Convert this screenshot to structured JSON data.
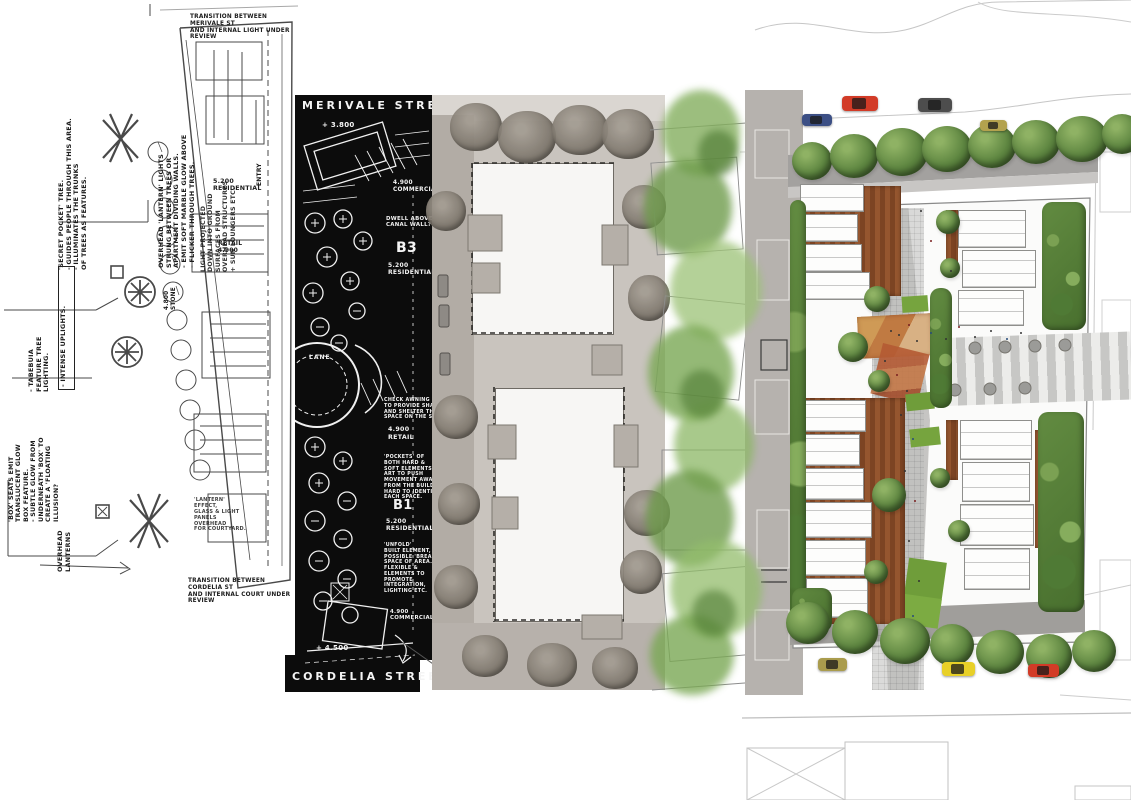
{
  "title": "Masterplan design process — sketch to render, Merivale to Cordelia Street",
  "colors": {
    "black_panel": "#0c0c0c",
    "collage_grey": "#c9c4be",
    "render_tree_green": "#5d8540",
    "rust_brown": "#8a4e2a",
    "plaza_orange": "#bf7a42",
    "car_red": "#d23b27",
    "car_dark_grey": "#4d4d4d",
    "car_yellow": "#e8d028",
    "car_tan": "#b3a24e",
    "car_blue": "#3c4f85"
  },
  "sketch": {
    "top_note": "TRANSITION BETWEEN MERIVALE ST\nAND INTERNAL LIGHT UNDER REVIEW",
    "bottom_note": "TRANSITION BETWEEN CORDELIA ST\nAND INTERNAL COURT UNDER\nREVIEW",
    "lantern_lights": "OVERHEAD 'LANTERN' LIGHTS\nSTRUNG BETWEEN TREES OR\nAPARTMENT DIVIDING WALLS.\n- EMIT SOFT MARBLE GLOW ABOVE\n- FLICKER THROUGH TREES.",
    "secret_pocket": "'SECRET POCKET' TREE.\n- GUIDES PEOPLE THROUGH THIS AREA.\n- ILLUMINATES THE TRUNKS\n  OF TREES AS FEATURES.",
    "tabebuia": "- TABEBUIA\n  FEATURE TREE\n  LIGHTING.",
    "intense_uplights": "- INTENSE UPLIGHTS.",
    "box_seats": "'BOX' SEATS EMIT\nTRANSLUCENT GLOW\nBOX FEATURE.\n- SUBTLE GLOW FROM\n  UNDERNEATH 'BOX' TO\n  CREATE A 'FLOATING\n  ILLUSION?",
    "overhead_lanterns": "OVERHEAD\nLANTERNS",
    "light_projected": "LIGHT PROJECTED\nDOWN INTO GROUND\nSURFACES FROM\nOVERHEAD STRUCTURES\n+ SUN LOUNGERS ETC.",
    "stone": "4.800\nSTONE",
    "entry": "ENTRY",
    "residential": "5.200\nRESIDENTIAL",
    "retail": "RETAIL\n4.900",
    "lantern_effect": "'LANTERN' EFFECT,\nGLASS & LIGHT\nPANELS OVERHEAD\nFOR COURTYARD."
  },
  "black_plan": {
    "street_top": "MERIVALE  STREET",
    "street_bottom": "CORDELIA  STREET",
    "level_top": "+ 3.800",
    "level_bottom": "+ 4.500",
    "commercial_top": "4.900\nCOMMERCIAL",
    "commercial_bottom": "4.900\nCOMMERCIAL",
    "dwell_note": "DWELL ABOVE\nCANAL WALL?",
    "b3": "B3",
    "b3_use": "5.200\nRESIDENTIAL",
    "awning_note": "CHECK AWNING\nTO PROVIDE SHADING\nAND SHELTER THE\nSPACE ON THE SOUTHWEST.",
    "retail_level": "4.900\nRETAIL",
    "pockets_note": "'POCKETS' OF\nBOTH HARD &\nSOFT ELEMENTS,\nART TO PUSH\nMOVEMENT AWAY\nFROM THE BUILDING.\nHARD TO IDENTIFY\nEACH SPACE.",
    "b1": "B1",
    "b1_use": "5.200\nRESIDENTIAL",
    "unfold_note": "'UNFOLD'\nBUILT ELEMENT,\nPOSSIBLE 'BREAKOUT'\nSPACE OF AREA.\nFLEXIBLE &\nELEMENTS TO\nPROMOTE\nINTEGRATION,\nLIGHTING ETC.",
    "lane": "LANE",
    "shifted_note": "SHIFTED TO\nREC REQUIREMENTS."
  }
}
